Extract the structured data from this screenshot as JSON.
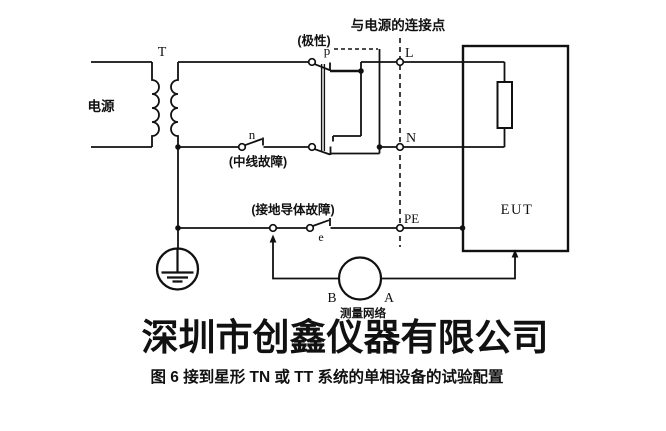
{
  "figure": {
    "transformer": "T",
    "source": "电源",
    "neutral_switch": "n",
    "neutral_fault": "(中线故障)",
    "polarity": "(极性)",
    "polarity_point": "p",
    "supply_connection": "与电源的连接点",
    "line_terminal": "L",
    "neutral_terminal": "N",
    "pe_terminal": "PE",
    "earth_fault": "(接地导体故障)",
    "earth_switch": "e",
    "eut": "EUT",
    "terminal_b": "B",
    "terminal_a": "A",
    "measuring_network": "测量网络"
  },
  "watermark": "深圳市创鑫仪器有限公司",
  "caption": "图 6  接到星形 TN 或 TT 系统的单相设备的试验配置"
}
